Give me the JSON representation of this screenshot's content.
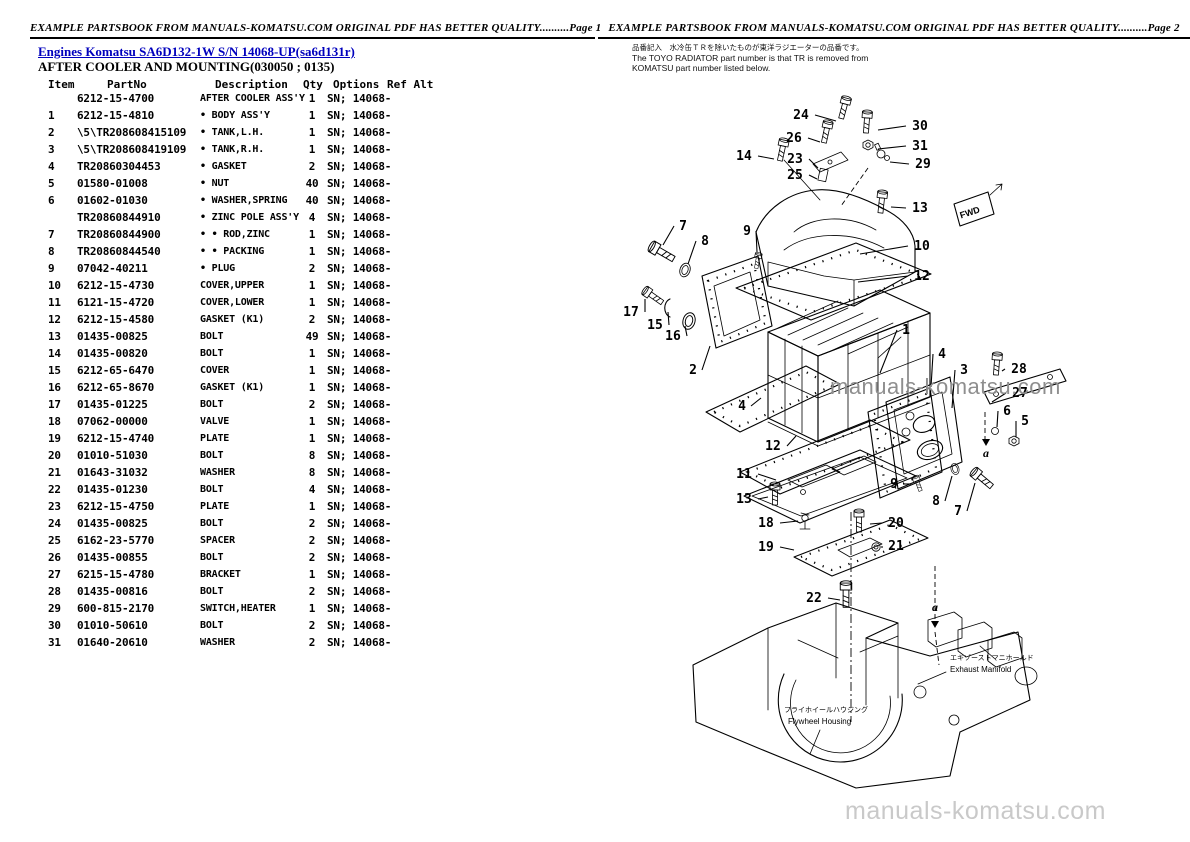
{
  "colors": {
    "link_blue": "#0000bd",
    "watermark_gray": "#8e8e8e",
    "watermark_light": "#c9c9c9"
  },
  "page_left": {
    "header": "EXAMPLE PARTSBOOK FROM MANUALS-KOMATSU.COM ORIGINAL PDF HAS BETTER QUALITY..........Page 1",
    "link": "Engines Komatsu SA6D132-1W S/N 14068-UP(sa6d131r)",
    "title": "AFTER COOLER AND MOUNTING(030050 ; 0135)",
    "columns": [
      "Item",
      "PartNo",
      "Description",
      "Qty",
      "Options",
      "Ref Alt"
    ],
    "rows": [
      {
        "item": "",
        "part": "6212-15-4700",
        "desc": "AFTER COOLER ASS'Y",
        "qty": "1",
        "opt": "SN; 14068-"
      },
      {
        "item": "1",
        "part": "6212-15-4810",
        "desc": "• BODY ASS'Y",
        "qty": "1",
        "opt": "SN; 14068-"
      },
      {
        "item": "2",
        "part": "\\5\\TR208608415109",
        "desc": "• TANK,L.H.",
        "qty": "1",
        "opt": "SN; 14068-"
      },
      {
        "item": "3",
        "part": "\\5\\TR208608419109",
        "desc": "• TANK,R.H.",
        "qty": "1",
        "opt": "SN; 14068-"
      },
      {
        "item": "4",
        "part": "TR20860304453",
        "desc": "• GASKET",
        "qty": "2",
        "opt": "SN; 14068-"
      },
      {
        "item": "5",
        "part": "01580-01008",
        "desc": "• NUT",
        "qty": "40",
        "opt": "SN; 14068-"
      },
      {
        "item": "6",
        "part": "01602-01030",
        "desc": "• WASHER,SPRING",
        "qty": "40",
        "opt": "SN; 14068-"
      },
      {
        "item": "",
        "part": "TR20860844910",
        "desc": "• ZINC POLE ASS'Y",
        "qty": "4",
        "opt": "SN; 14068-"
      },
      {
        "item": "7",
        "part": "TR20860844900",
        "desc": "• • ROD,ZINC",
        "qty": "1",
        "opt": "SN; 14068-"
      },
      {
        "item": "8",
        "part": "TR20860844540",
        "desc": "• • PACKING",
        "qty": "1",
        "opt": "SN; 14068-"
      },
      {
        "item": "9",
        "part": "07042-40211",
        "desc": "• PLUG",
        "qty": "2",
        "opt": "SN; 14068-"
      },
      {
        "item": "10",
        "part": "6212-15-4730",
        "desc": "COVER,UPPER",
        "qty": "1",
        "opt": "SN; 14068-"
      },
      {
        "item": "11",
        "part": "6121-15-4720",
        "desc": "COVER,LOWER",
        "qty": "1",
        "opt": "SN; 14068-"
      },
      {
        "item": "12",
        "part": "6212-15-4580",
        "desc": "GASKET (K1)",
        "qty": "2",
        "opt": "SN; 14068-"
      },
      {
        "item": "13",
        "part": "01435-00825",
        "desc": "BOLT",
        "qty": "49",
        "opt": "SN; 14068-"
      },
      {
        "item": "14",
        "part": "01435-00820",
        "desc": "BOLT",
        "qty": "1",
        "opt": "SN; 14068-"
      },
      {
        "item": "15",
        "part": "6212-65-6470",
        "desc": "COVER",
        "qty": "1",
        "opt": "SN; 14068-"
      },
      {
        "item": "16",
        "part": "6212-65-8670",
        "desc": "GASKET (K1)",
        "qty": "1",
        "opt": "SN; 14068-"
      },
      {
        "item": "17",
        "part": "01435-01225",
        "desc": "BOLT",
        "qty": "2",
        "opt": "SN; 14068-"
      },
      {
        "item": "18",
        "part": "07062-00000",
        "desc": "VALVE",
        "qty": "1",
        "opt": "SN; 14068-"
      },
      {
        "item": "19",
        "part": "6212-15-4740",
        "desc": "PLATE",
        "qty": "1",
        "opt": "SN; 14068-"
      },
      {
        "item": "20",
        "part": "01010-51030",
        "desc": "BOLT",
        "qty": "8",
        "opt": "SN; 14068-"
      },
      {
        "item": "21",
        "part": "01643-31032",
        "desc": "WASHER",
        "qty": "8",
        "opt": "SN; 14068-"
      },
      {
        "item": "22",
        "part": "01435-01230",
        "desc": "BOLT",
        "qty": "4",
        "opt": "SN; 14068-"
      },
      {
        "item": "23",
        "part": "6212-15-4750",
        "desc": "PLATE",
        "qty": "1",
        "opt": "SN; 14068-"
      },
      {
        "item": "24",
        "part": "01435-00825",
        "desc": "BOLT",
        "qty": "2",
        "opt": "SN; 14068-"
      },
      {
        "item": "25",
        "part": "6162-23-5770",
        "desc": "SPACER",
        "qty": "2",
        "opt": "SN; 14068-"
      },
      {
        "item": "26",
        "part": "01435-00855",
        "desc": "BOLT",
        "qty": "2",
        "opt": "SN; 14068-"
      },
      {
        "item": "27",
        "part": "6215-15-4780",
        "desc": "BRACKET",
        "qty": "1",
        "opt": "SN; 14068-"
      },
      {
        "item": "28",
        "part": "01435-00816",
        "desc": "BOLT",
        "qty": "2",
        "opt": "SN; 14068-"
      },
      {
        "item": "29",
        "part": "600-815-2170",
        "desc": "SWITCH,HEATER",
        "qty": "1",
        "opt": "SN; 14068-"
      },
      {
        "item": "30",
        "part": "01010-50610",
        "desc": "BOLT",
        "qty": "2",
        "opt": "SN; 14068-"
      },
      {
        "item": "31",
        "part": "01640-20610",
        "desc": "WASHER",
        "qty": "2",
        "opt": "SN; 14068-"
      }
    ]
  },
  "page_right": {
    "header": "EXAMPLE PARTSBOOK FROM MANUALS-KOMATSU.COM ORIGINAL PDF HAS BETTER QUALITY..........Page 2",
    "note_jp": "品番記入　水冷缶ＴＲを除いたものが東洋ラジエーターの品番です。",
    "note_en1": "The TOYO RADIATOR part number is that TR is removed from",
    "note_en2": "KOMATSU part number listed below.",
    "watermark": "manuals-komatsu.com",
    "labels": {
      "fwd": "FWD",
      "a_marker": "a",
      "exhaust_jp": "エキゾーストマニホールド",
      "exhaust_en": "Exhaust  Manifold",
      "flywheel_jp": "フライホイールハウジング",
      "flywheel_en": "Flywheel  Housing"
    },
    "callouts": [
      {
        "n": "24",
        "x": 203,
        "y": 39,
        "x2": 238,
        "y2": 41
      },
      {
        "n": "30",
        "x": 322,
        "y": 50,
        "x2": 280,
        "y2": 50
      },
      {
        "n": "26",
        "x": 196,
        "y": 62,
        "x2": 222,
        "y2": 62
      },
      {
        "n": "31",
        "x": 322,
        "y": 70,
        "x2": 280,
        "y2": 69
      },
      {
        "n": "14",
        "x": 146,
        "y": 80,
        "x2": 176,
        "y2": 79
      },
      {
        "n": "23",
        "x": 197,
        "y": 83,
        "x2": 220,
        "y2": 88
      },
      {
        "n": "29",
        "x": 325,
        "y": 88,
        "x2": 292,
        "y2": 82
      },
      {
        "n": "25",
        "x": 197,
        "y": 99,
        "x2": 219,
        "y2": 99
      },
      {
        "n": "13",
        "x": 322,
        "y": 132,
        "x2": 293,
        "y2": 127
      },
      {
        "n": "10",
        "x": 324,
        "y": 170,
        "x2": 262,
        "y2": 174
      },
      {
        "n": "12",
        "x": 324,
        "y": 200,
        "x2": 260,
        "y2": 202
      },
      {
        "n": "7",
        "x": 85,
        "y": 150,
        "x2": 65,
        "y2": 165
      },
      {
        "n": "8",
        "x": 107,
        "y": 165,
        "x2": 90,
        "y2": 184
      },
      {
        "n": "9",
        "x": 149,
        "y": 155,
        "x2": 159,
        "y2": 172
      },
      {
        "n": "17",
        "x": 33,
        "y": 236,
        "x2": 47,
        "y2": 219
      },
      {
        "n": "15",
        "x": 57,
        "y": 249,
        "x2": 70,
        "y2": 232
      },
      {
        "n": "16",
        "x": 75,
        "y": 260,
        "x2": 87,
        "y2": 246
      },
      {
        "n": "2",
        "x": 95,
        "y": 294,
        "x2": 112,
        "y2": 266
      },
      {
        "n": "1",
        "x": 308,
        "y": 254,
        "x2": 282,
        "y2": 293
      },
      {
        "n": "4",
        "x": 344,
        "y": 278,
        "x2": 333,
        "y2": 307
      },
      {
        "n": "3",
        "x": 366,
        "y": 294,
        "x2": 354,
        "y2": 328
      },
      {
        "n": "28",
        "x": 421,
        "y": 293,
        "x2": 404,
        "y2": 291
      },
      {
        "n": "27",
        "x": 422,
        "y": 317,
        "x2": 394,
        "y2": 322
      },
      {
        "n": "6",
        "x": 409,
        "y": 335,
        "x2": 399,
        "y2": 347
      },
      {
        "n": "5",
        "x": 427,
        "y": 345,
        "x2": 418,
        "y2": 357
      },
      {
        "n": "4",
        "x": 144,
        "y": 330,
        "x2": 163,
        "y2": 318
      },
      {
        "n": "12",
        "x": 175,
        "y": 370,
        "x2": 198,
        "y2": 356
      },
      {
        "n": "11",
        "x": 146,
        "y": 398,
        "x2": 178,
        "y2": 400
      },
      {
        "n": "13",
        "x": 146,
        "y": 423,
        "x2": 170,
        "y2": 417
      },
      {
        "n": "18",
        "x": 168,
        "y": 447,
        "x2": 200,
        "y2": 441
      },
      {
        "n": "19",
        "x": 168,
        "y": 471,
        "x2": 196,
        "y2": 470
      },
      {
        "n": "20",
        "x": 298,
        "y": 447,
        "x2": 272,
        "y2": 444
      },
      {
        "n": "21",
        "x": 298,
        "y": 470,
        "x2": 284,
        "y2": 468
      },
      {
        "n": "22",
        "x": 216,
        "y": 522,
        "x2": 242,
        "y2": 520
      },
      {
        "n": "9",
        "x": 296,
        "y": 408,
        "x2": 313,
        "y2": 404
      },
      {
        "n": "8",
        "x": 338,
        "y": 425,
        "x2": 354,
        "y2": 396
      },
      {
        "n": "7",
        "x": 360,
        "y": 435,
        "x2": 377,
        "y2": 403
      }
    ],
    "a_markers": [
      {
        "x": 388,
        "y": 377,
        "tx": 388,
        "ty": 366
      },
      {
        "x": 337,
        "y": 531,
        "tx": 337,
        "ty": 548
      }
    ]
  }
}
